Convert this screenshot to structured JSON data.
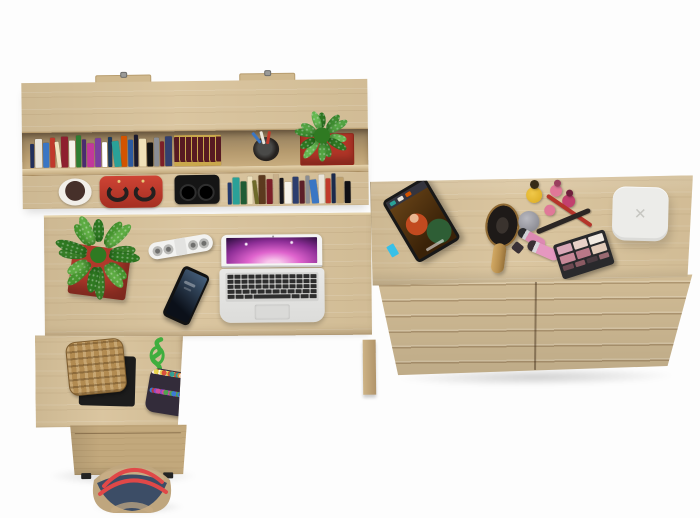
{
  "meta": {
    "description": "Top-down 3D product render of a light-oak home office set: wall shelf with books, L-shaped desk with laptop, wicker stool, and a wide chest of drawers with cosmetics.",
    "background": "#fdfdfd"
  },
  "palette": {
    "oak": "#d8c29a",
    "oak_light": "#e4d1aa",
    "oak_dark": "#c2a87c",
    "oak_edge": "#a98d60"
  },
  "shelf": {
    "label": "wall shelf with books",
    "books_top": [
      "#22305c",
      "#e9e5db",
      "#3a76c4",
      "#c0392b",
      "#efe3c0",
      "#8e1f2f",
      "#f5f2ea",
      "#2e7d32",
      "#4a2c6f",
      "#c2389b",
      "#7b3fa0",
      "#ffffff",
      "#1b3a5c",
      "#2aa198",
      "#d35400",
      "#2c5aa0",
      "#1a1a2e",
      "#efe0b8",
      "#111111",
      "#8a8d93",
      "#7c1f28",
      "#33406e"
    ],
    "encyclopedia": {
      "cover": "#571a22",
      "gilt": "#c9a84c"
    },
    "pen_cup": {
      "cup": "#26221f",
      "pens": [
        "#3a76c4",
        "#e9e5db",
        "#c0392b"
      ]
    },
    "planter": {
      "pot": "#b23527",
      "pot_edge": "#8e2418",
      "leaves": [
        "#2f7a22",
        "#3f8f31",
        "#55a844",
        "#6abf55"
      ]
    },
    "bowl": {
      "rim": "#f1eee8",
      "fill": "#46302a"
    },
    "handbag": {
      "body": "#ce4334",
      "shade": "#a52f22",
      "handles": "#24201f"
    },
    "headphones": {
      "body": "#151515",
      "detail": "#2f2f2f"
    },
    "books_bottom": [
      "#223a6e",
      "#2aa198",
      "#1f5c34",
      "#efe3c0",
      "#6e6a2a",
      "#5c3a1e",
      "#7c1f28",
      "#c9b08a",
      "#15151c",
      "#f5f2ea",
      "#2c3e6e",
      "#5c1f28",
      "#8a8d93",
      "#3a76c4",
      "#e9e5db",
      "#c0392b",
      "#1b2a4c",
      "#bfa26e",
      "#101014"
    ]
  },
  "desk": {
    "label": "L-shaped desk",
    "plant": {
      "pot": "#b1392b",
      "leaves": [
        "#2f7a22",
        "#47982f",
        "#5fae44",
        "#387f27"
      ]
    },
    "power_strip": {
      "body": "#f2f2f0",
      "socket_ring": "#b9b9b6",
      "socket_hole": "#6f6f6d",
      "sockets": 4
    },
    "phone": {
      "body": "#121212",
      "screen_top": "#46607c",
      "screen_bottom": "#0b1019"
    },
    "laptop": {
      "shell": "#e9e9e7",
      "bezel": "#f4f4f3",
      "hinge": "#c9c9c7",
      "key": "#2e2e2e",
      "deck": "#d3d3d1",
      "trackpad": "#dadad8",
      "wallpaper": {
        "core": "#f8c7ec",
        "mid": "#df63cd",
        "outer": "#8b2d95",
        "rim": "#200a33"
      },
      "key_rows": [
        13,
        13,
        13,
        12
      ],
      "space_row": [
        1,
        1,
        1.2,
        5,
        1.2,
        1,
        1
      ]
    }
  },
  "return_unit": {
    "stool": {
      "wicker": "#b28b51",
      "weave": "#7d5c2e",
      "base": "#1c1c1c"
    },
    "pouch": {
      "body": "#332c3a",
      "rope": "#3fae3e",
      "beads": [
        "#d94a3a",
        "#3a7bd9",
        "#e8d44a",
        "#4aa84a",
        "#ffffff",
        "#d44a9e",
        "#e8883a",
        "#7a4ad9",
        "#2aa198",
        "#c0392b"
      ]
    }
  },
  "cabinet": {
    "label": "under-desk cabinet",
    "feet": "#262626"
  },
  "tote": {
    "outer": "#bfa67e",
    "panel": "#3c4d66",
    "lining": "#c7ad85",
    "handles": "#e04848"
  },
  "dresser": {
    "label": "wide chest of drawers",
    "tablet": {
      "frame": "#181818",
      "menubar": "#34343e",
      "scene_bg": "#3a2208",
      "hair": "#c24a1f",
      "skin": "#e8b690",
      "dress": "#2e5e35",
      "tab": "#37c0e8",
      "thumbs": [
        "#2aa198",
        "#e9e5db",
        "#d35400"
      ]
    },
    "hairbrush": {
      "handle": "#b9904f",
      "rim": "#a87b3e",
      "pad": "#1e1a18"
    },
    "cosmetics": {
      "nail_yellow": {
        "body": "#d9a91e",
        "cap": "#352b16"
      },
      "nail_pink": {
        "body": "#e07898",
        "cap": "#9a3f5e"
      },
      "nail_magenta": {
        "body": "#c2406e",
        "cap": "#6e1f3c"
      },
      "jar": {
        "outer": "#7e7e86",
        "inner": "#b9b9c0"
      },
      "liner_red": "#b5342a",
      "brush_black": "#2b2624",
      "lipstick_a": {
        "tube": "#dd8ab2",
        "band": "#cfcfd4",
        "base": "#2b2b2e"
      },
      "lipstick_b": {
        "tube": "#e598c0",
        "band": "#d8d8dc",
        "base": "#3a3136"
      },
      "palette": {
        "case": "#29292c",
        "swatches": [
          "#d9a8b8",
          "#e8d0c8",
          "#f2eae2",
          "#c88898",
          "#b87888",
          "#e2cab8"
        ],
        "lower": [
          "#6e4a52",
          "#8a5a62",
          "#4a3a40",
          "#9a6a72"
        ]
      }
    },
    "device": {
      "body": "#ecece9",
      "glyph": "✕",
      "glyph_color": "#c6c6c1"
    }
  }
}
